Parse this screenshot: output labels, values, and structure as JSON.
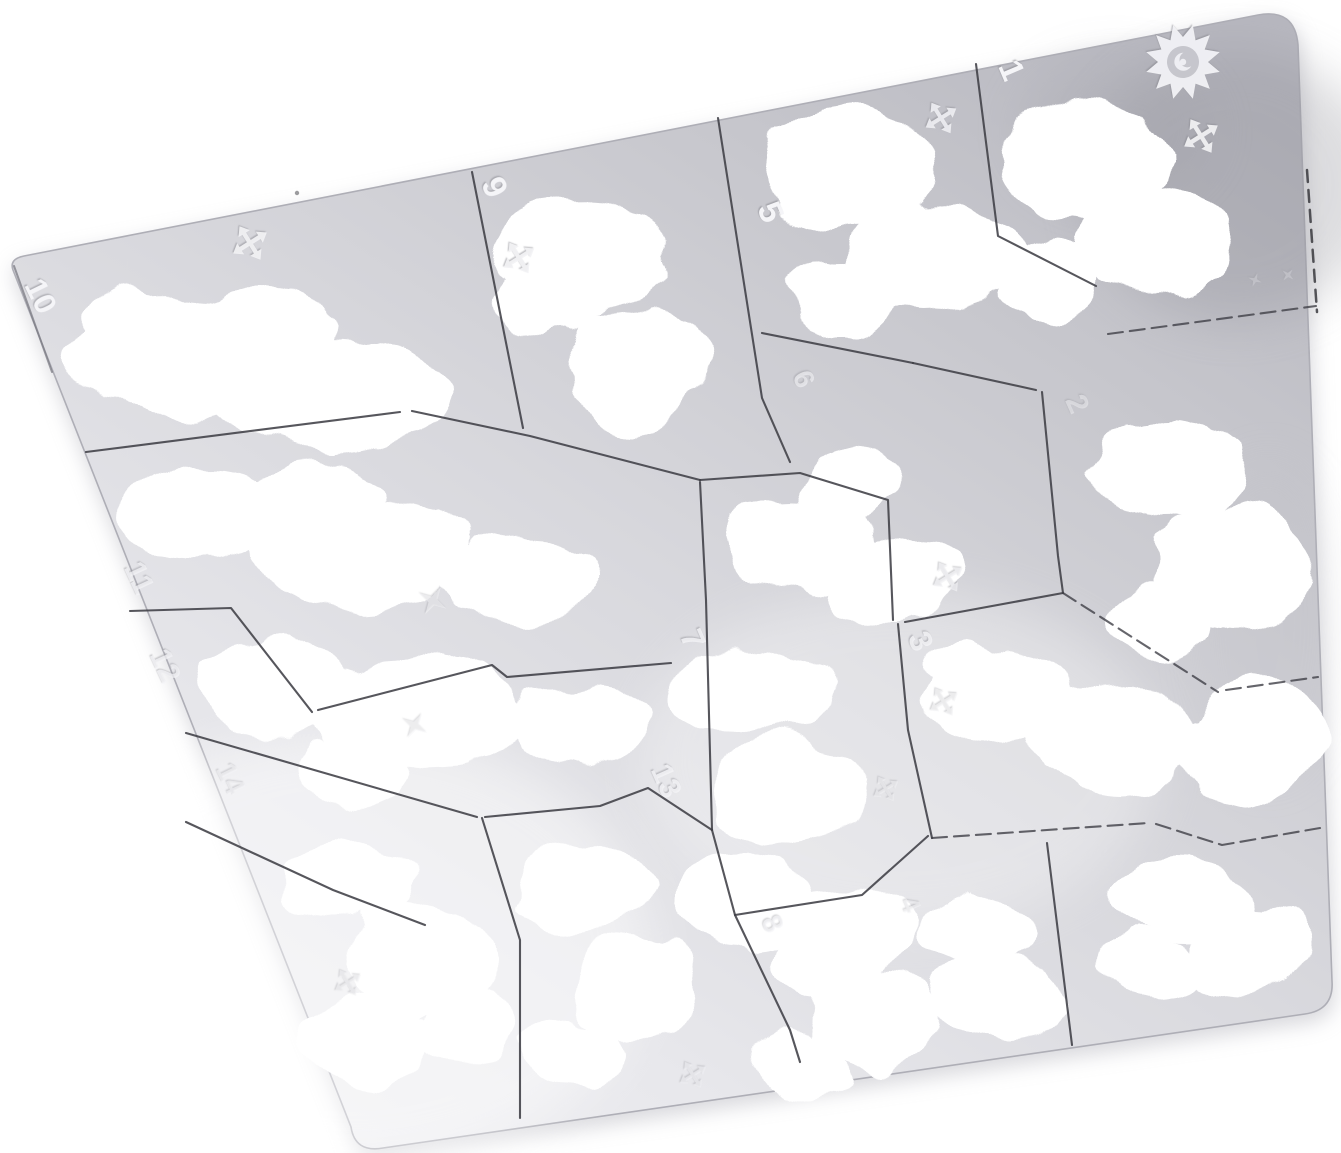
{
  "meta": {
    "description": "Product photograph of a silver stainless-steel camouflage airbrush stencil template plate, tilted on a pure white background. The plate is divided by thin laser-cut lines into fourteen numbered stencil sections, each with a large cloud / camo shaped cutout. Small four-arrow cross marks, four-point stars and a jagged sunburst logo are etched into the metal near the numbered sections."
  },
  "colors": {
    "background": "#ffffff",
    "plate_dark": "#b7b7bf",
    "plate_mid": "#cfcfd5",
    "plate_light": "#ededf0",
    "cut_line": "#3f3f46",
    "etch_mark": "#f5f5f8",
    "reflection_shadow": "#8e8e96"
  },
  "plate": {
    "labels": [
      {
        "text": "1"
      },
      {
        "text": "2"
      },
      {
        "text": "3"
      },
      {
        "text": "4"
      },
      {
        "text": "5"
      },
      {
        "text": "6"
      },
      {
        "text": "7"
      },
      {
        "text": "8"
      },
      {
        "text": "9"
      },
      {
        "text": "10"
      },
      {
        "text": "11"
      },
      {
        "text": "12"
      },
      {
        "text": "13"
      },
      {
        "text": "14"
      }
    ],
    "icons": [
      {
        "name": "sunburst-logo-icon"
      },
      {
        "name": "four-arrow-cross-icon"
      },
      {
        "name": "four-point-star-icon"
      }
    ]
  }
}
